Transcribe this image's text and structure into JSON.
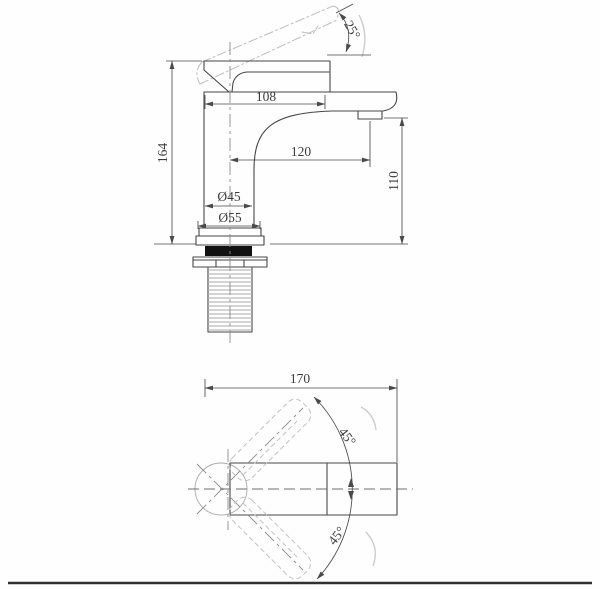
{
  "colors": {
    "outline": "#474747",
    "phantom": "#bdbdbd",
    "centerline": "#8a8a8a",
    "gasket_fill": "#111111",
    "border_line": "#303030"
  },
  "front_view": {
    "labels": {
      "handle_angle": "25°",
      "top_width": "108",
      "overall_height": "164",
      "spout_reach": "120",
      "outlet_height": "110",
      "body_diameter": "Ø45",
      "base_diameter": "Ø55"
    }
  },
  "top_view": {
    "labels": {
      "overall_length": "170",
      "handle_swing_upper": "45°",
      "handle_swing_lower": "45°"
    }
  }
}
